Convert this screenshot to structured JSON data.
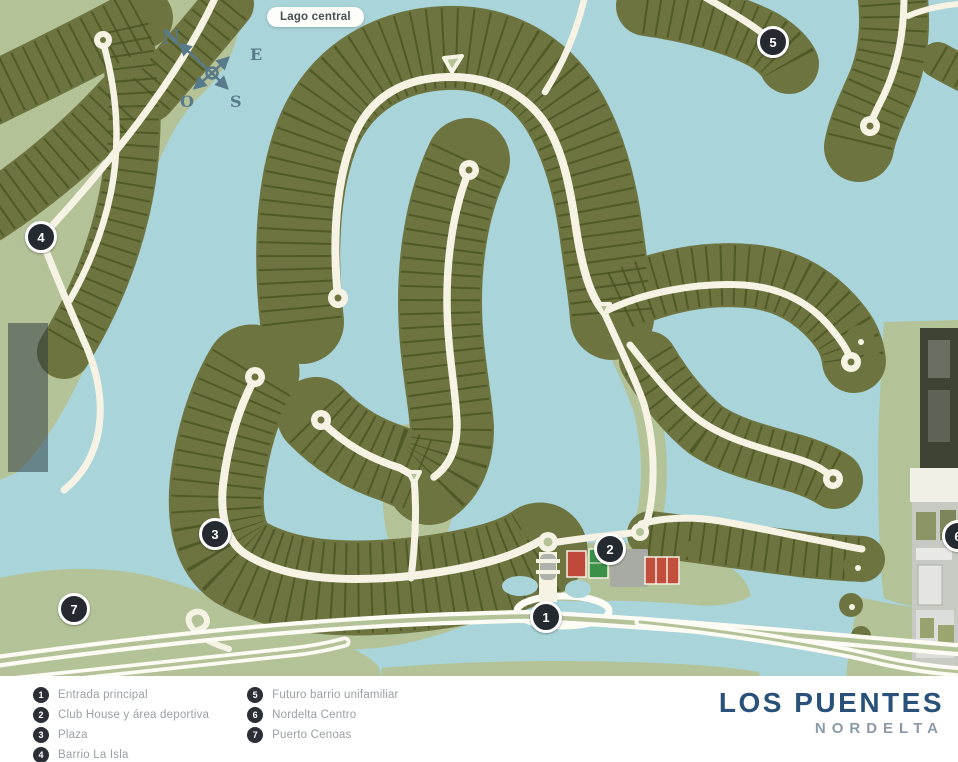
{
  "map": {
    "badge": "Lago central",
    "compass": {
      "n": "N",
      "e": "E",
      "o": "O",
      "s": "S"
    },
    "markers": [
      {
        "number": "1"
      },
      {
        "number": "2"
      },
      {
        "number": "3"
      },
      {
        "number": "4"
      },
      {
        "number": "5"
      },
      {
        "number": "6"
      },
      {
        "number": "7"
      }
    ]
  },
  "legend": {
    "items": [
      {
        "number": "1",
        "label": "Entrada principal"
      },
      {
        "number": "2",
        "label": "Club House y área deportiva"
      },
      {
        "number": "3",
        "label": "Plaza"
      },
      {
        "number": "4",
        "label": "Barrio La Isla"
      },
      {
        "number": "5",
        "label": "Futuro barrio unifamiliar"
      },
      {
        "number": "6",
        "label": "Nordelta Centro"
      },
      {
        "number": "7",
        "label": "Puerto Cenoas"
      }
    ]
  },
  "branding": {
    "title": "LOS PUENTES",
    "subtitle": "NORDELTA"
  },
  "colors": {
    "water": "#a9d4d9",
    "land": "#b4c298",
    "lots": "#6d7440",
    "lot_lines": "#47511f",
    "road": "#f6f3e4",
    "highway": "#fcfbf4",
    "marker_bg": "#252a31",
    "brand_navy": "#29517a",
    "brand_gray": "#8b99a8",
    "legend_text": "#9b9fa2",
    "court_red": "#c24e3c",
    "field_green": "#3c9149"
  }
}
